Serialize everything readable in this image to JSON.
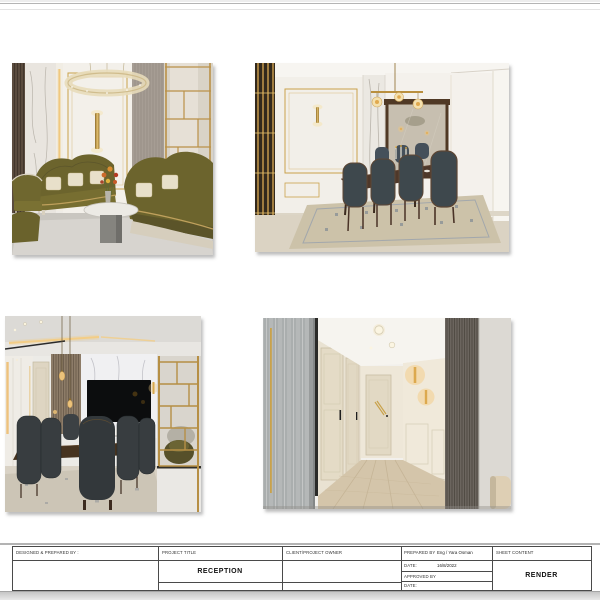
{
  "palette": {
    "accent_gold": "#c9a24b",
    "olive_velvet": "#6c642d",
    "charcoal_chair": "#3e484d",
    "dark_wood": "#4e382a",
    "marble_white": "#ebe8e2",
    "wall_gray": "#a69d94",
    "page_white": "#ffffff",
    "rule_gray": "#b3b3b3"
  },
  "renders": [
    {
      "name": "living-room",
      "label": "Reception living room render - olive velvet sofas, crystal ring chandelier, gold partition"
    },
    {
      "name": "dining-room",
      "label": "Dining room render - dark wood table, teal chairs, framed mirror, globe pendant"
    },
    {
      "name": "dining-tv-wall",
      "label": "Dining area render - marble TV wall, wood slats, gold partition screen"
    },
    {
      "name": "hallway",
      "label": "Hallway render - cream doors, fluted panels, glowing gold sconces"
    }
  ],
  "title_block": {
    "designed_prepared_by_label": "DESIGNED & PREPARED BY :",
    "project_title_label": "PROJECT TITLE",
    "project_title_value": "RECEPTION",
    "client_label": "CLIENT/PROJECT OWNER",
    "prepared_by_label": "PREPARED BY",
    "prepared_by_value": "Eng / Yara Osman",
    "date_label": "DATE:",
    "date_value": "16/8/2022",
    "approved_by_label": "APPROVED BY",
    "approved_date_label": "DATE:",
    "sheet_content_label": "SHEET CONTENT",
    "sheet_content_value": "RENDER"
  }
}
